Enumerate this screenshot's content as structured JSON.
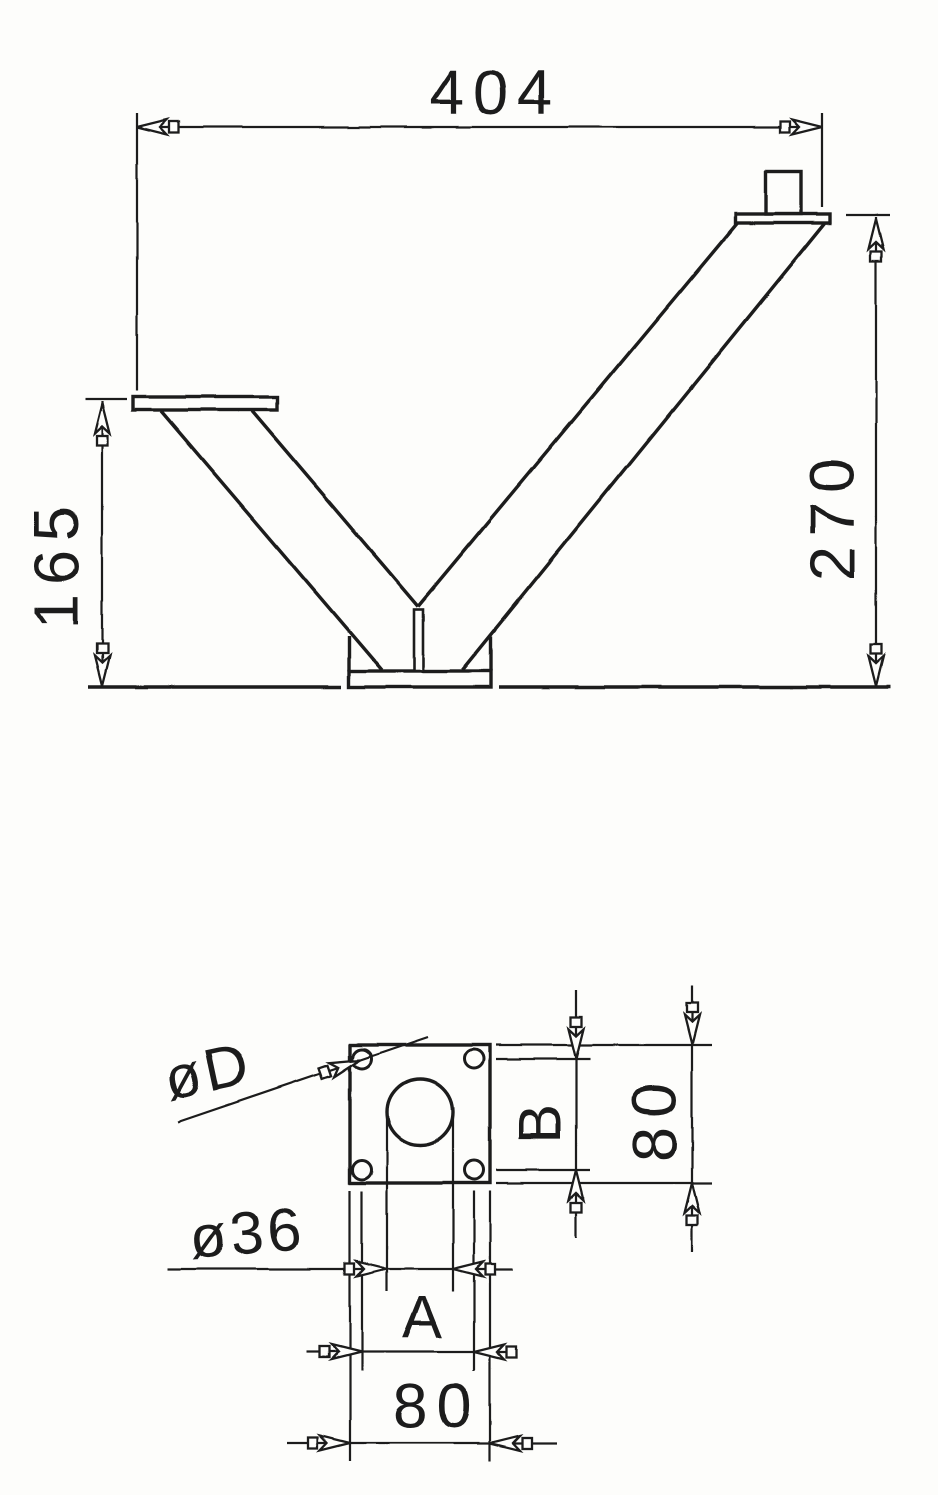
{
  "page": {
    "paper_color": "#fdfdfb",
    "ink_color": "#1c1c1c"
  },
  "front_view": {
    "overall_width": "404",
    "left_support_height": "165",
    "right_support_height": "270"
  },
  "plan_view": {
    "corner_hole_diameter": "øD",
    "center_hole_diameter": "ø36",
    "hole_pitch_horizontal": "A",
    "hole_pitch_vertical": "B",
    "plate_width": "80",
    "plate_height": "80"
  }
}
